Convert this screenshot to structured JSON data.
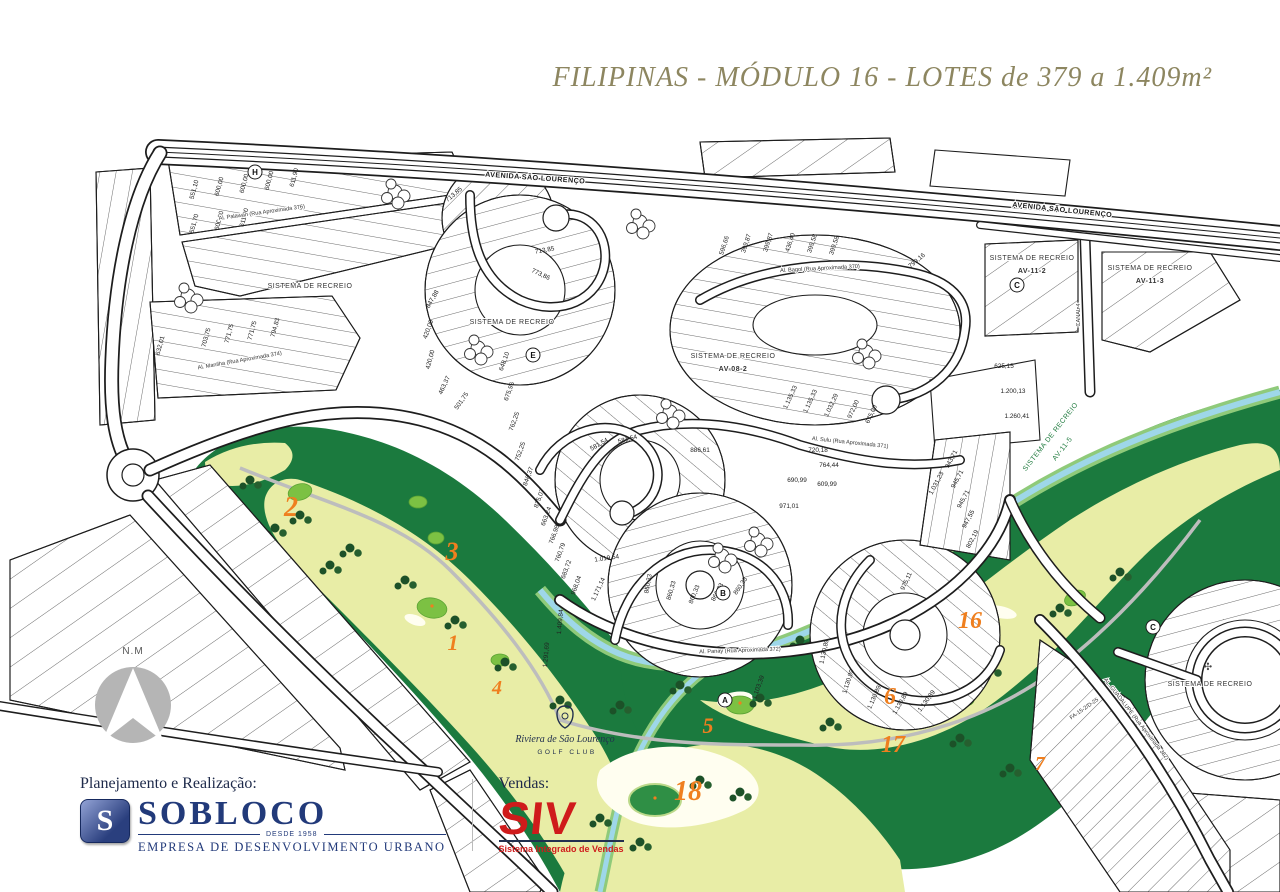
{
  "title": "FILIPINAS - MÓDULO 16 - LOTES de 379 a 1.409m²",
  "compass": {
    "label": "N.M"
  },
  "map": {
    "streets": [
      "AVENIDA SÃO LOURENÇO",
      "AVENIDA SÃO LOURENÇO",
      "Al. Palawan (Rua Aproximada 376)",
      "Al. Manilha (Rua Aproximada 374)",
      "Al. Bagol (Rua Aproximada 370)",
      "Al. Sulu (Rua Aproximada 371)",
      "Al. Panay (Rua Aproximada 372)",
      "AL. GUADALUPE (Rua Aproximada 382)",
      "CANAL 4",
      "FA-15-2/D-25"
    ],
    "recreation_areas": [
      {
        "line1": "SISTEMA DE RECREIO",
        "code": ""
      },
      {
        "line1": "SISTEMA DE RECREIO",
        "code": ""
      },
      {
        "line1": "SISTEMA DE RECREIO",
        "code": "AV-08-2"
      },
      {
        "line1": "SISTEMA DE RECREIO",
        "code": "AV-11-2"
      },
      {
        "line1": "SISTEMA DE RECREIO",
        "code": "AV-11-3"
      },
      {
        "line1": "SISTEMA DE RECREIO",
        "code": "AV-11-5"
      },
      {
        "line1": "SISTEMA DE RECREIO",
        "code": ""
      }
    ],
    "recreation_glyph": "✣",
    "golf_holes": [
      "2",
      "3",
      "1",
      "4",
      "18",
      "5",
      "6",
      "17",
      "16",
      "7"
    ],
    "golf_club": {
      "name": "Riviera de São Lourenço",
      "subtitle": "GOLF CLUB"
    },
    "lot_markers": [
      "H",
      "E",
      "B",
      "A",
      "C",
      "C"
    ],
    "lot_areas": [
      "551,10",
      "600,00",
      "600,00",
      "600,00",
      "611,90",
      "713,85",
      "713,85",
      "773,86",
      "551,70",
      "600,00",
      "611,90",
      "703,75",
      "771,75",
      "771,75",
      "794,83",
      "632,01",
      "847,88",
      "420,00",
      "420,00",
      "463,37",
      "501,75",
      "648,10",
      "675,96",
      "762,25",
      "752,25",
      "846,37",
      "875,07",
      "663,24",
      "766,98",
      "760,79",
      "683,72",
      "968,04",
      "1.019,54",
      "1.171,14",
      "1.409,84",
      "1.291,69",
      "581,54",
      "581,54",
      "886,61",
      "720,18",
      "764,44",
      "690,99",
      "609,99",
      "971,01",
      "860,33",
      "860,33",
      "860,33",
      "860,33",
      "860,33",
      "1.103,39",
      "1.135,33",
      "1.135,33",
      "1.032,29",
      "972,00",
      "675,00",
      "596,66",
      "399,87",
      "399,87",
      "436,40",
      "399,58",
      "399,58",
      "799,16",
      "625,15",
      "1.200,13",
      "1.260,41",
      "1.031,23",
      "943,71",
      "945,71",
      "945,71",
      "947,55",
      "802,19",
      "975,11",
      "1.130,89",
      "1.130,89",
      "1.130,89",
      "1.130,89",
      "1.130,89"
    ]
  },
  "footer": {
    "planning_label": "Planejamento e Realização:",
    "sobloco_name": "SOBLOCO",
    "sobloco_since": "DESDE 1958",
    "sobloco_tagline": "EMPRESA DE DESENVOLVIMENTO URBANO",
    "sales_label": "Vendas:",
    "siv_name": "SIV",
    "siv_tagline": "Sistema Integrado de Vendas"
  },
  "colors": {
    "title_olive": "#8d8660",
    "golf_dark": "#1b7a3e",
    "golf_fairway": "#e8eda6",
    "golf_green": "#7cc143",
    "water": "#9ed7e9",
    "hole_orange": "#ef7f1f",
    "navy": "#223a7a",
    "red": "#cf1b1b"
  }
}
